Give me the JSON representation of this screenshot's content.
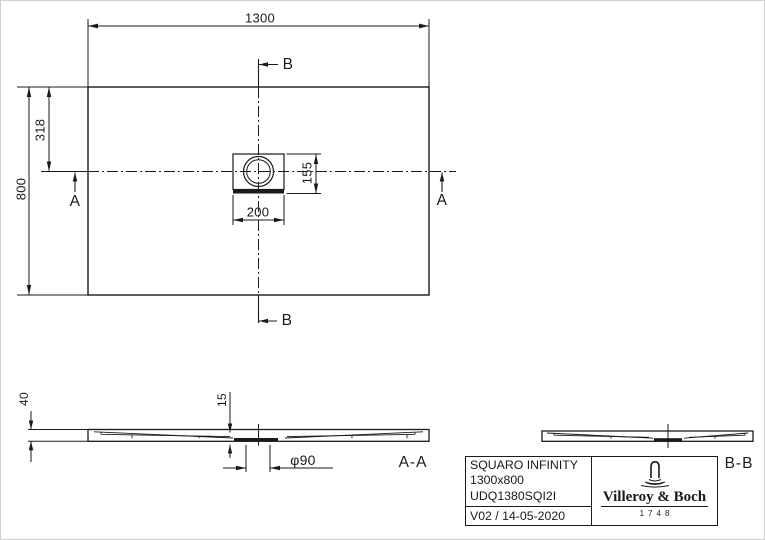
{
  "plan_view": {
    "width_dim": "1300",
    "height_dim": "800",
    "drain_offset_dim": "318",
    "drain_box_width_dim": "200",
    "drain_box_height_dim": "155",
    "section_a_label": "A",
    "section_b_label": "B"
  },
  "section_aa": {
    "label": "A-A",
    "height_dim": "40",
    "recess_depth_dim": "15",
    "drain_diameter_dim": "φ90"
  },
  "section_bb": {
    "label": "B-B"
  },
  "title_block": {
    "product_name": "SQUARO INFINITY",
    "size": "1300x800",
    "article_number": "UDQ1380SQI2I",
    "revision": "V02 / 14-05-2020",
    "brand_name": "Villeroy & Boch",
    "brand_founded": "1748"
  },
  "colors": {
    "line": "#1a1a1a",
    "background": "#ffffff"
  }
}
